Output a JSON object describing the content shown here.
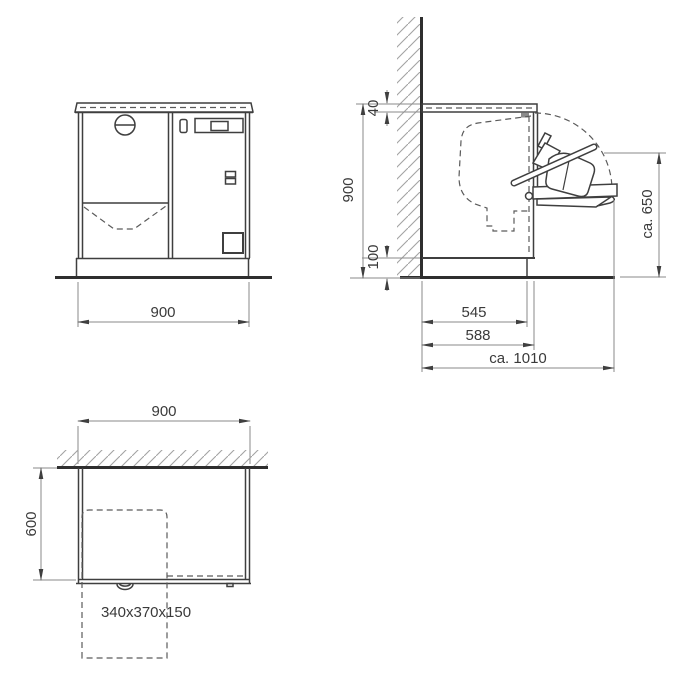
{
  "drawing": {
    "type": "appliance-installation-dimension-drawing",
    "front_view": {
      "width": "900"
    },
    "side_view": {
      "worktop_thickness": "40",
      "height": "900",
      "plinth_height": "100",
      "depth_to_plinth_front": "545",
      "depth_to_body_front": "588",
      "depth_door_open": "ca. 1010",
      "door_open_height": "ca. 650"
    },
    "plan_view": {
      "width": "900",
      "depth": "600",
      "box_size": "340x370x150"
    },
    "colors": {
      "background": "#ffffff",
      "object_line": "#3f3f3f",
      "thick_line": "#2e2e2e",
      "dimension_line": "#8a8a8a",
      "dashed_line": "#5a5a5a",
      "hatch_line": "#a3a3a3",
      "text": "#3a3a3a"
    }
  }
}
